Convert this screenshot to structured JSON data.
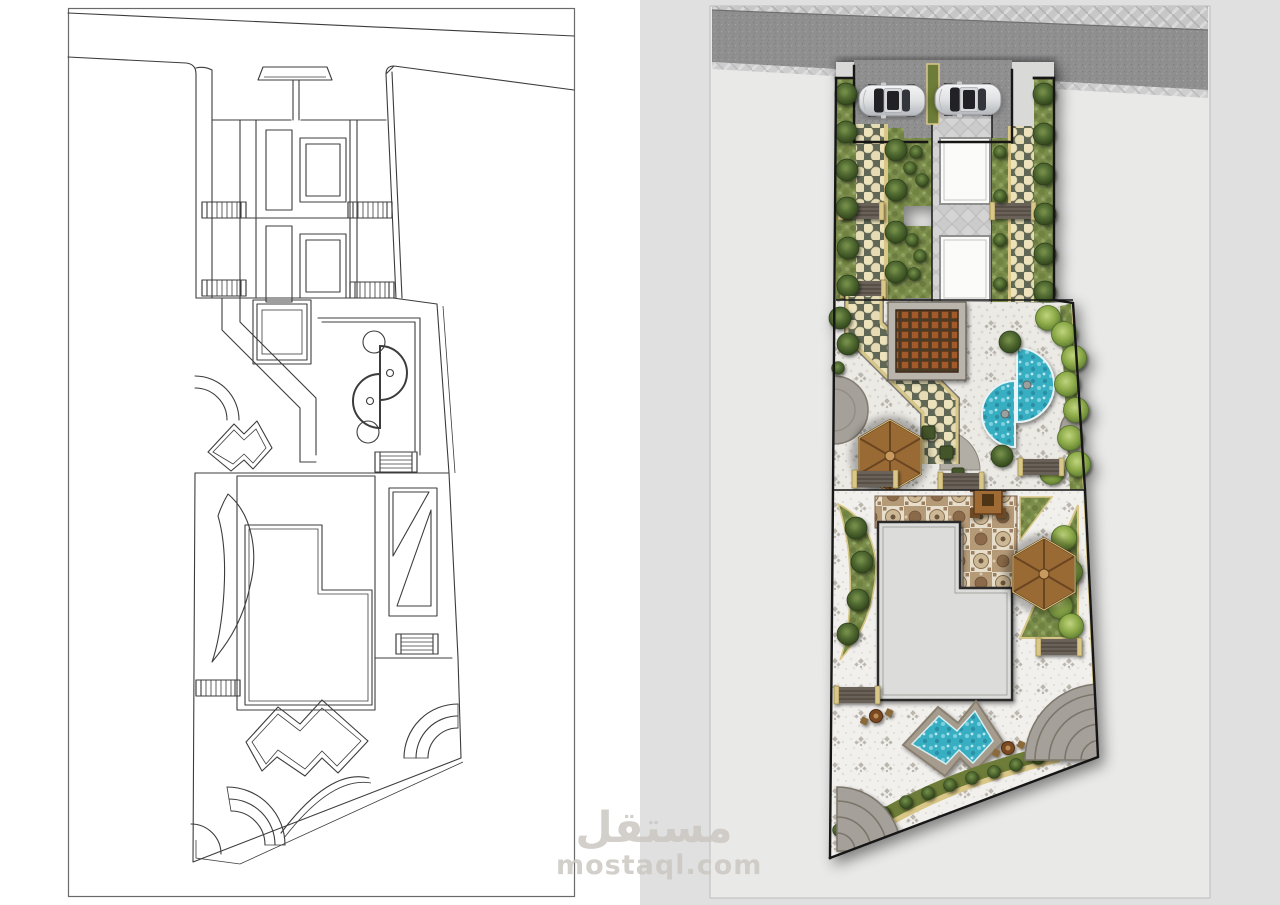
{
  "watermark": {
    "arabic": "مستقل",
    "domain": "mostaql.com"
  },
  "colors": {
    "page_bg": "#ffffff",
    "panel_bg": "#e0e0e0",
    "inner_panel_bg": "#e9e9e8",
    "cad_line": "#3c3c3c",
    "asphalt": "#8f8f8f",
    "sidewalk": "#c7c7c7",
    "curb": "#b9b9b9",
    "lawn": "#7b8d4c",
    "tree_dark": "#3c5524",
    "tree_light": "#8caa48",
    "paver_bg": "#606855",
    "paver_dot": "#ece3bd",
    "tan_edge": "#d9c787",
    "stone": "#eceae5",
    "court_white": "#fbfbfa",
    "frame_gray": "#8f8f8f",
    "steps_dark": "#5d564e",
    "wood": "#9a6a35",
    "wood_dark": "#4a3a28",
    "tile_cream": "#e7decb",
    "tile_brown": "#b59a78",
    "pool_water": "#38aec3",
    "pool_deck": "#a59c8e",
    "boundary": "#141414",
    "car_body": "#d9dadb",
    "car_glass": "#202226",
    "plaza_gray": "#a5a19a",
    "hedge": "#6d7c37",
    "watermark_gray": "#ccc8c3"
  }
}
